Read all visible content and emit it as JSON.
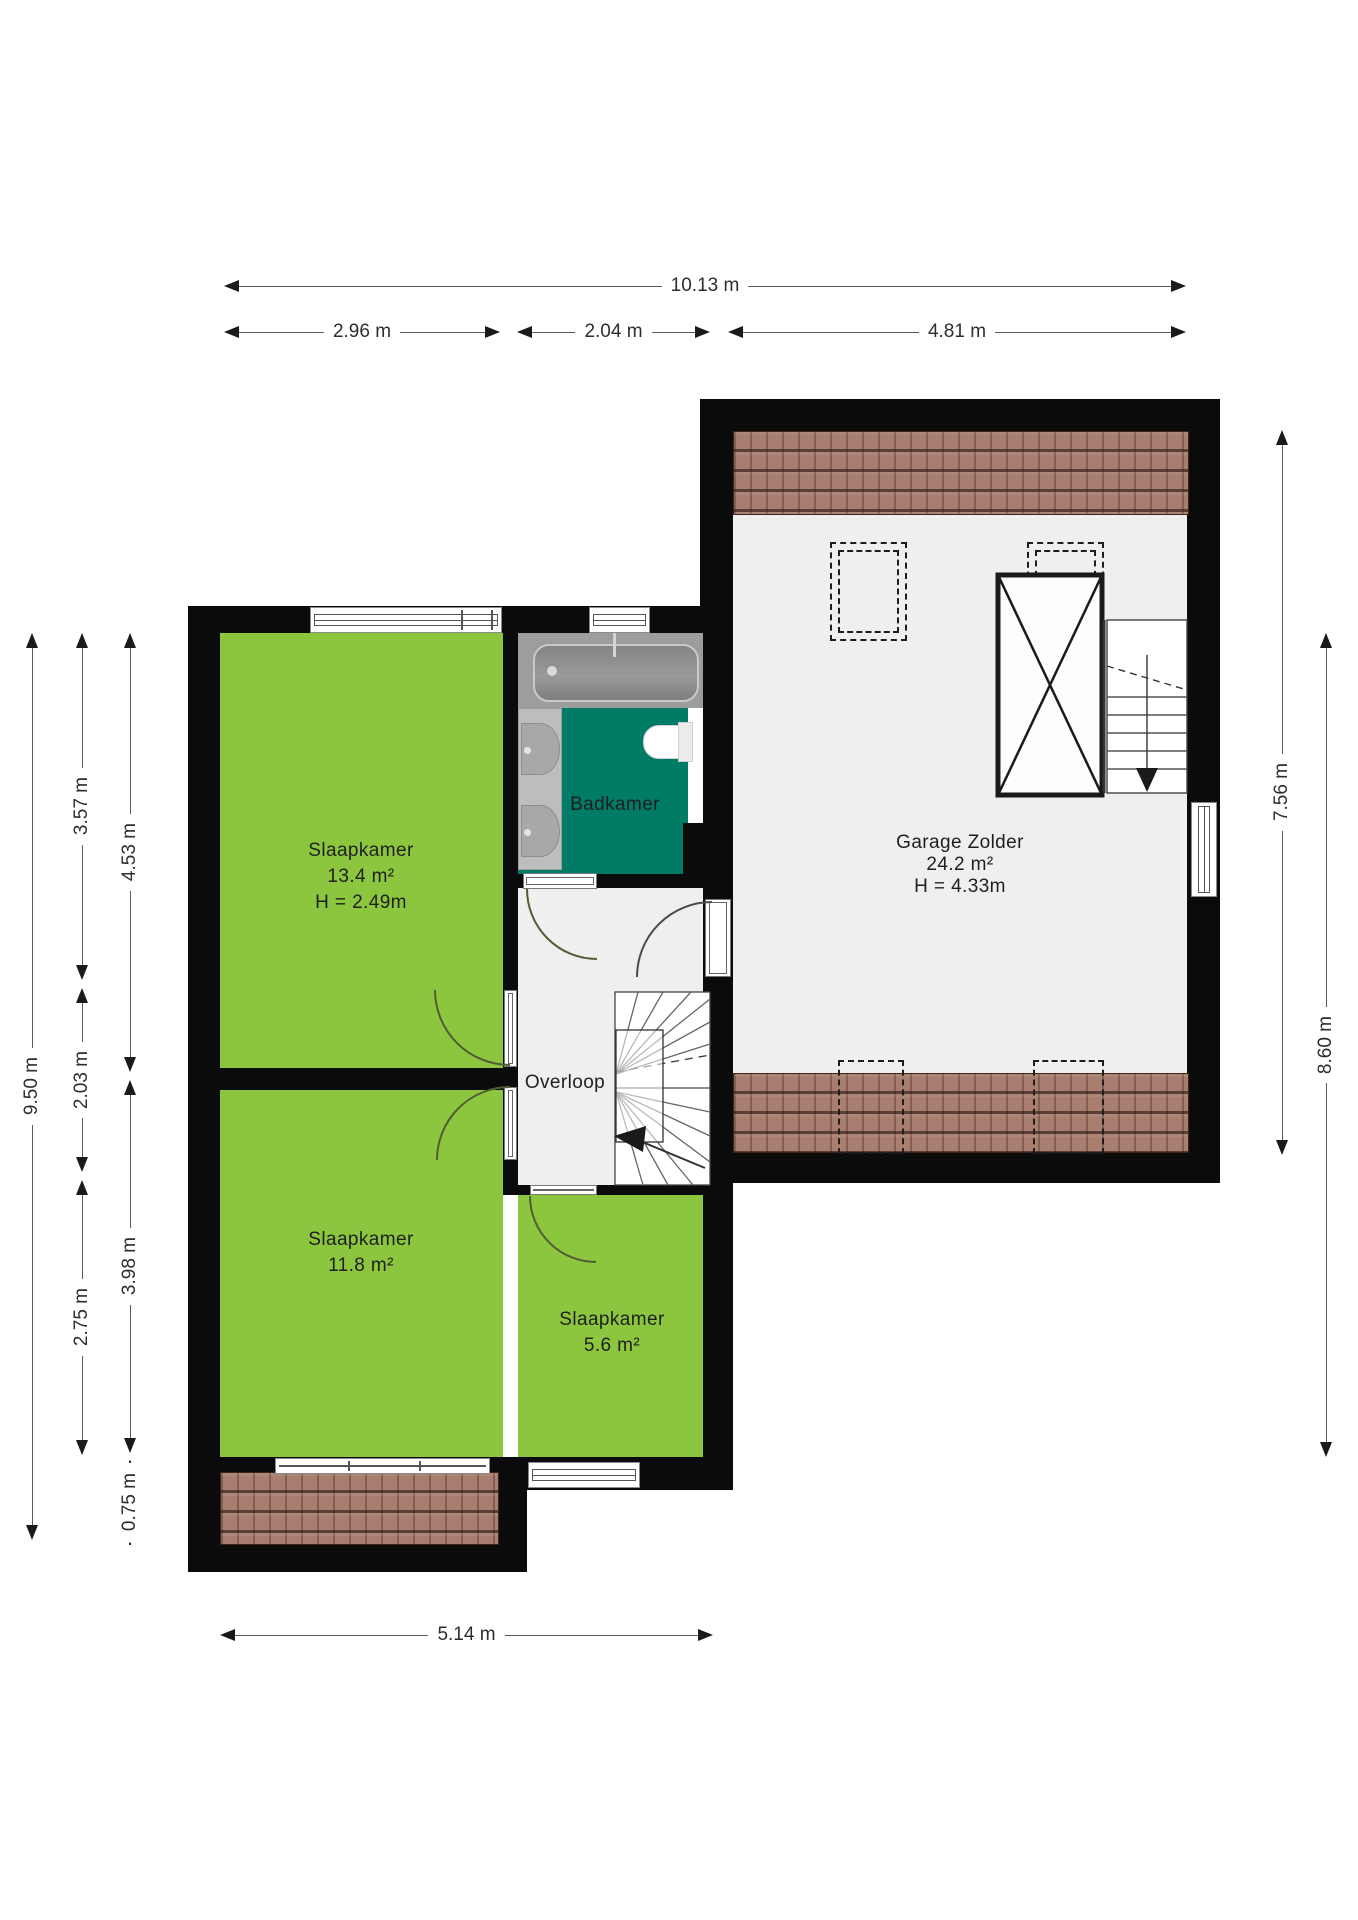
{
  "plan_title": "Floor plan - verdieping",
  "rooms": [
    {
      "name": "Slaapkamer",
      "area": "13.4 m²",
      "height": "H = 2.49m"
    },
    {
      "name": "Badkamer"
    },
    {
      "name": "Overloop"
    },
    {
      "name": "Garage Zolder",
      "area": "24.2 m²",
      "height": "H = 4.33m"
    },
    {
      "name": "Slaapkamer",
      "area": "11.8 m²"
    },
    {
      "name": "Slaapkamer",
      "area": "5.6 m²"
    }
  ],
  "dimensions": {
    "top_total": "10.13 m",
    "top_segments": [
      "2.96 m",
      "2.04 m",
      "4.81 m"
    ],
    "left_total": "9.50 m",
    "left_col2": [
      "3.57 m",
      "2.03 m",
      "2.75 m"
    ],
    "left_col3": [
      "4.53 m",
      "3.98 m",
      "0.75 m"
    ],
    "right": [
      "7.56 m",
      "8.60 m"
    ],
    "bottom": "5.14 m"
  },
  "colors": {
    "room_green": "#8cc63f",
    "bathroom_teal": "#007b66",
    "floor_gray": "#efefef",
    "wall_black": "#0b0b0b",
    "roof_tile_brown": "#a77e6f",
    "dimension_text": "#2e2e2e"
  }
}
